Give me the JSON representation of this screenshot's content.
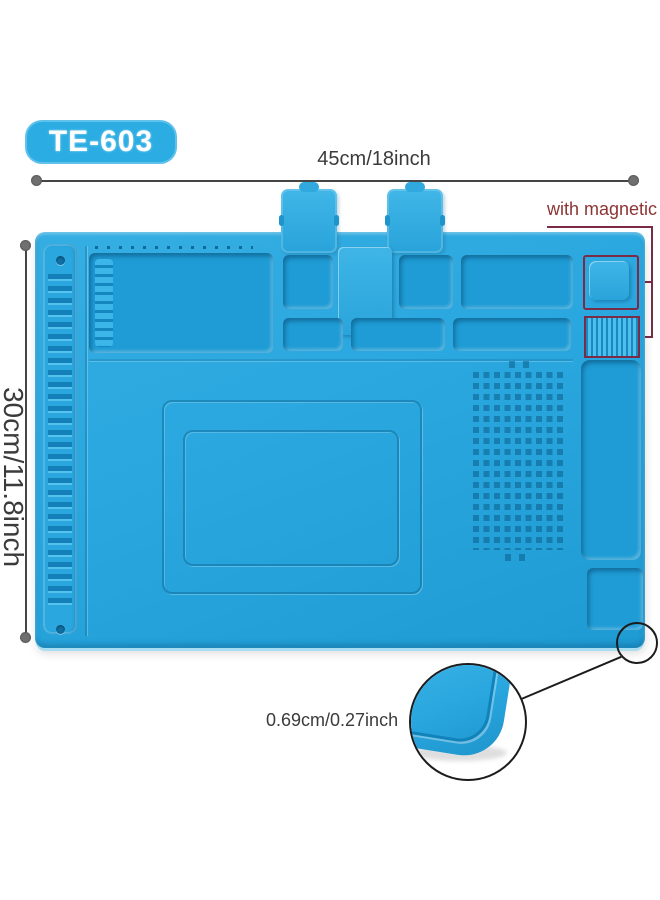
{
  "badge": {
    "label": "TE-603"
  },
  "dimensions": {
    "width_label": "45cm/18inch",
    "height_label": "30cm/11.8inch",
    "thickness_label": "0.69cm/0.27inch"
  },
  "magnetic": {
    "label": "with magnetic"
  },
  "colors": {
    "page_bg": "#ffffff",
    "badge_blue": "#2bade3",
    "mat_blue": "#2aa7df",
    "mat_side": "#a8ddf2",
    "annotation_text": "#3b3b3b",
    "dim_line": "#454545",
    "dim_dot": "#707070",
    "magnetic_text": "#8d3434",
    "magnetic_outline": "#7c2b46",
    "callout_black": "#1c1c1c"
  }
}
